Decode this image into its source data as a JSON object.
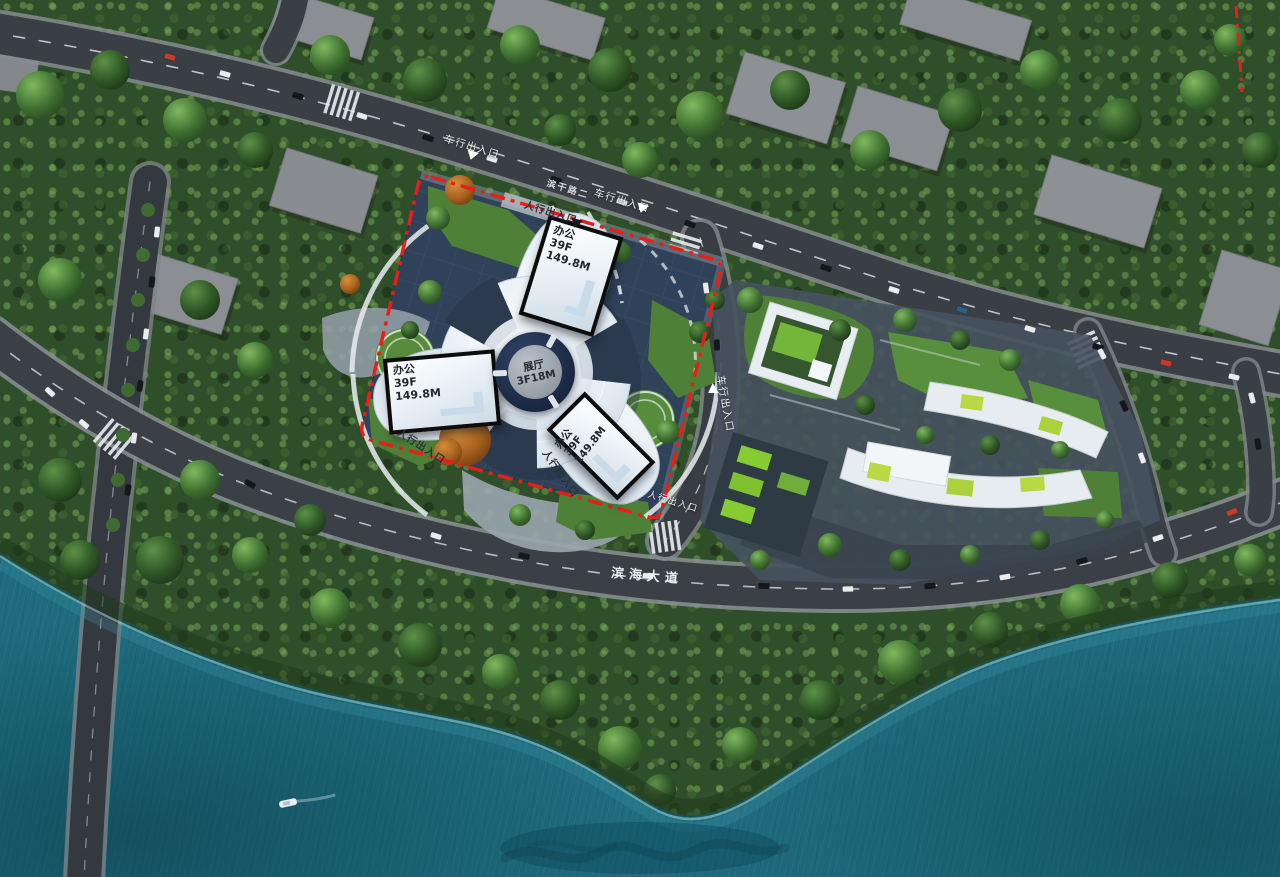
{
  "meta": {
    "scene": "aerial-masterplan-render"
  },
  "colors": {
    "water": "#1d6b7d",
    "foliage": "#2f4e2a",
    "road": "#3a3f45",
    "site_pavement": "#30425a",
    "boundary_red": "#e62019",
    "lawn_green": "#4f8038",
    "lime_roof": "#85cc33",
    "building_white": "#eef3f7",
    "roof_gray": "#8b8f93"
  },
  "site": {
    "towers": [
      {
        "use": "办公",
        "floors": "39F",
        "height": "149.8M"
      },
      {
        "use": "办公",
        "floors": "39F",
        "height": "149.8M"
      },
      {
        "use": "办公",
        "floors": "39F",
        "height": "149.8M"
      }
    ],
    "exhibition_hall": {
      "name": "展厅",
      "spec": "3F18M"
    }
  },
  "roads": {
    "coastal_avenue": "滨海大道",
    "north_road_marking": "滨干路二"
  },
  "markers": {
    "vehicle_entrance": "车行出入口",
    "pedestrian_entrance": "人行出入口"
  }
}
